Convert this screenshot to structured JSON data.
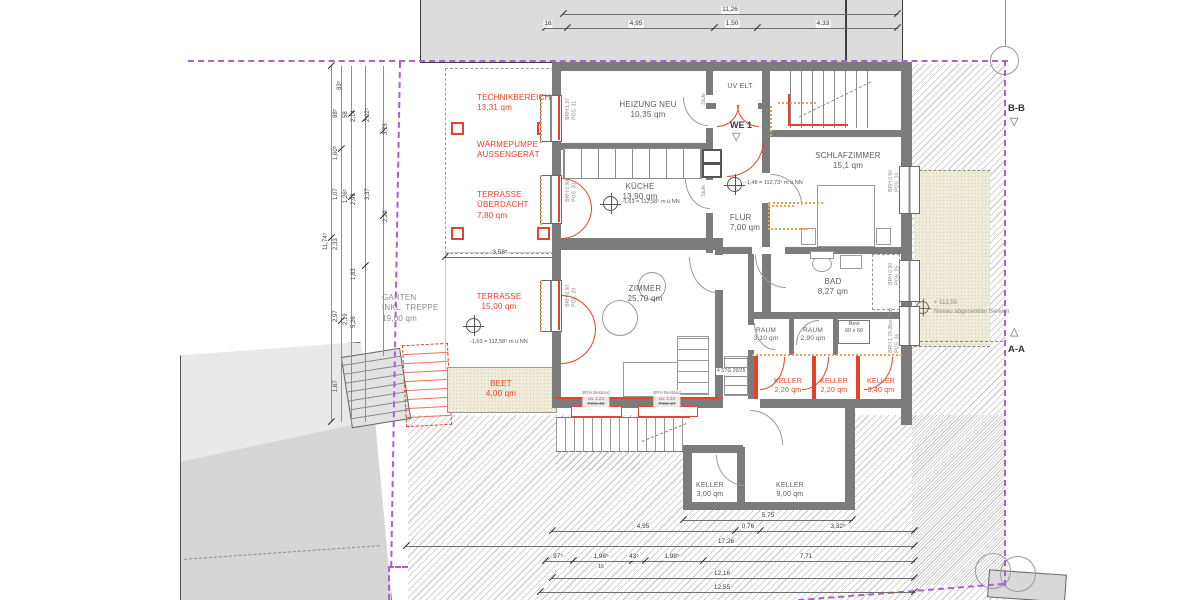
{
  "colors": {
    "boundary": "#ab5fd2",
    "red": "#e8412a",
    "orange": "#f0a24b"
  },
  "markers": {
    "bb": "B-B",
    "aa": "A-A",
    "we": "WE 1",
    "tri_down": "▽",
    "tri_up": "△"
  },
  "rooms": {
    "heizung": {
      "name": "HEIZUNG NEU",
      "area": "10,35 qm"
    },
    "kueche": {
      "name": "KÜCHE",
      "area": "13,90 qm"
    },
    "zimmer": {
      "name": "ZIMMER",
      "area": "25,70 qm"
    },
    "schlafzimmer": {
      "name": "SCHLAFZIMMER",
      "area": "15,1 qm"
    },
    "flur": {
      "name": "FLUR",
      "area": "7,00 qm"
    },
    "bad": {
      "name": "BAD",
      "area": "8,27 qm"
    },
    "raum1": {
      "name": "RAUM",
      "area": "3,10 qm"
    },
    "raum2": {
      "name": "RAUM",
      "area": "2,90 qm"
    },
    "uv": {
      "name": "UV ELT"
    },
    "keller_a": {
      "name": "KELLER",
      "area": "3,00 qm"
    },
    "keller_b": {
      "name": "KELLER",
      "area": "9,00 qm"
    }
  },
  "red_labels": {
    "technik": {
      "l1": "TECHNIKBEREICH",
      "l2": "13,31 qm"
    },
    "waermepumpe": {
      "l1": "WÄRMEPUMPE",
      "l2": "AUSSENGERÄT"
    },
    "terrasse_ueberdacht": {
      "l1": "TERRASSE",
      "l2": "ÜBERDACHT",
      "l3": "7,80 qm"
    },
    "terrasse": {
      "l1": "TERRASSE",
      "l2": "15,00 qm"
    },
    "beet": {
      "l1": "BEET",
      "l2": "4,00 qm"
    },
    "keller1": {
      "l1": "KELLER",
      "l2": "2,20 qm"
    },
    "keller2": {
      "l1": "KELLER",
      "l2": "2,20 qm"
    },
    "keller3": {
      "l1": "KELLER",
      "l2": "3,40 qm"
    }
  },
  "garten": {
    "l1": "GARTEN",
    "l2": "INKL. TREPPE",
    "l3": "19,00 qm"
  },
  "levels": {
    "kueche": "-1,63 = 112,58⁵ m ü NN",
    "flur": "-1,48 = 112,73⁵ m ü NN",
    "terrasse": "-1,63 = 112,58⁵ m ü NN",
    "niveau_value": "+ 113,55",
    "niveau_note": "Niveau abgesenkter Bereich"
  },
  "windows": {
    "pos31": {
      "brh": "BRH 1,37",
      "pos": "POS. 31"
    },
    "pos30": {
      "brh": "BRH 0,90",
      "pos": "POS. 30"
    },
    "pos29": {
      "brh": "BRH 0,90",
      "pos": "POS. 29"
    },
    "pos24": {
      "brh": "BRH 0,90",
      "pos": "POS. 24"
    },
    "pos25": {
      "brh": "BRH 0,90",
      "pos": "POS. 25"
    },
    "pos26": {
      "brh": "BRH 1,78 (Bestand)",
      "pos": "POS. 26"
    },
    "pos28": {
      "l1": "BRH Bestand",
      "l2": "ca. 1,23",
      "l3": "POS. 28"
    },
    "pos27": {
      "l1": "BRH Bestand",
      "l2": "ca. 1,23",
      "l3": "POS. 27"
    }
  },
  "notes": {
    "stufe": "Stufe",
    "stg": "4 STG 20/25",
    "revi1": "Revi",
    "revi2": "60 x 60"
  },
  "dims": {
    "top1": "11,26",
    "top2a": "16",
    "top2b": "4,95",
    "top2c": "1,50",
    "top2d": "4,33",
    "overhang": "3,58⁵",
    "annex": "5,75",
    "b1a": "4,95",
    "b1b": "0,76",
    "b1c": "3,32⁵",
    "b2": "17,26",
    "b3a": "97⁵",
    "b3b": "1,98⁵",
    "b3c": "43⁵",
    "b3d": "1,98⁵",
    "b3e": "7,71",
    "b3sub": "16",
    "b4": "12,16",
    "b5": "12,55",
    "left": [
      "11,74⁵",
      "2,33",
      "2,97",
      "2,19",
      "5,26",
      "1,07",
      "1,26⁵",
      "2,98",
      "1,60⁵",
      "88⁵",
      "58",
      "2,14",
      "83⁵",
      "2,02⁵",
      "3,75",
      "3,37",
      "2,29",
      "1,83",
      "1,67"
    ]
  }
}
